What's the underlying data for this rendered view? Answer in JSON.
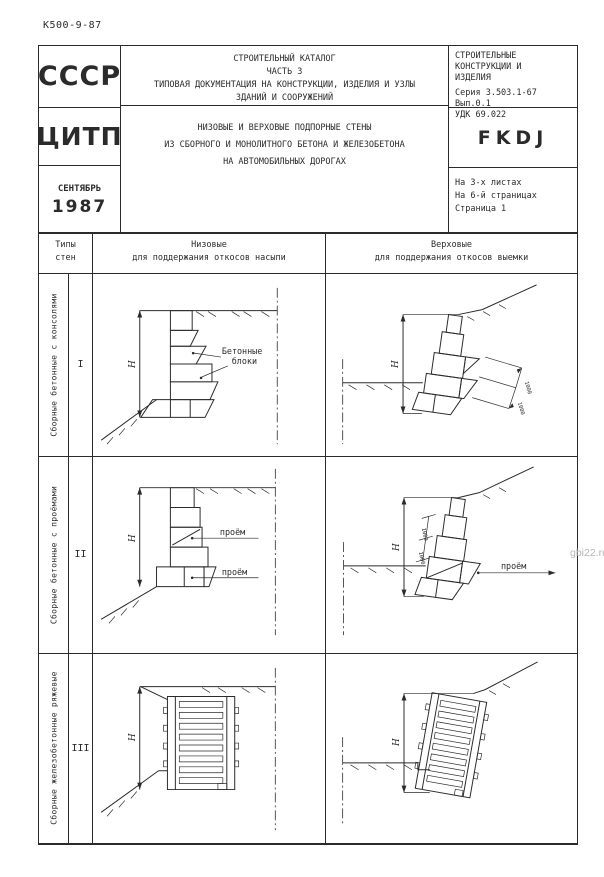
{
  "page": {
    "doc_number": "К500-9-87",
    "watermark": "gbi22.ru"
  },
  "header": {
    "org": "СССР",
    "catalog": {
      "l1": "СТРОИТЕЛЬНЫЙ  КАТАЛОГ",
      "l2": "ЧАСТЬ  3",
      "l3": "ТИПОВАЯ ДОКУМЕНТАЦИЯ  НА  КОНСТРУКЦИИ, ИЗДЕЛИЯ  И  УЗЛЫ",
      "l4": "ЗДАНИЙ  И  СООРУЖЕНИЙ"
    },
    "right": {
      "l1": "СТРОИТЕЛЬНЫЕ",
      "l2": "КОНСТРУКЦИИ  И",
      "l3": "ИЗДЕЛИЯ",
      "series": "Серия 3.503.1-67",
      "issue": "Вып.0.1",
      "udk": "УДК 69.022"
    },
    "publisher": "ЦИТП",
    "title": {
      "l1": "НИЗОВЫЕ  И  ВЕРХОВЫЕ  ПОДПОРНЫЕ  СТЕНЫ",
      "l2": "ИЗ  СБОРНОГО  И  МОНОЛИТНОГО  БЕТОНА  И  ЖЕЛЕЗОБЕТОНА",
      "l3": "НА  АВТОМОБИЛЬНЫХ  ДОРОГАХ"
    },
    "code": "FKDJ",
    "date": {
      "month": "СЕНТЯБРЬ",
      "year": "1987"
    },
    "pages": {
      "l1": "На 3-х листах",
      "l2": "На 6-й страницах",
      "l3": "Страница 1"
    }
  },
  "table": {
    "headers": {
      "types_l1": "Типы",
      "types_l2": "стен",
      "low_l1": "Низовые",
      "low_l2": "для поддержания откосов насыпи",
      "high_l1": "Верховые",
      "high_l2": "для поддержания откосов выемки"
    },
    "rows": [
      {
        "numeral": "I",
        "type_label": "Сборные бетонные с консолями"
      },
      {
        "numeral": "II",
        "type_label": "Сборные бетонные с проёмами"
      },
      {
        "numeral": "III",
        "type_label": "Сборные железобетонные ряжевые"
      }
    ]
  },
  "drawings": {
    "dim_height": "Н",
    "dim_small": "1000",
    "blocks_l1": "Бетонные",
    "blocks_l2": "блоки",
    "opening": "проём"
  }
}
